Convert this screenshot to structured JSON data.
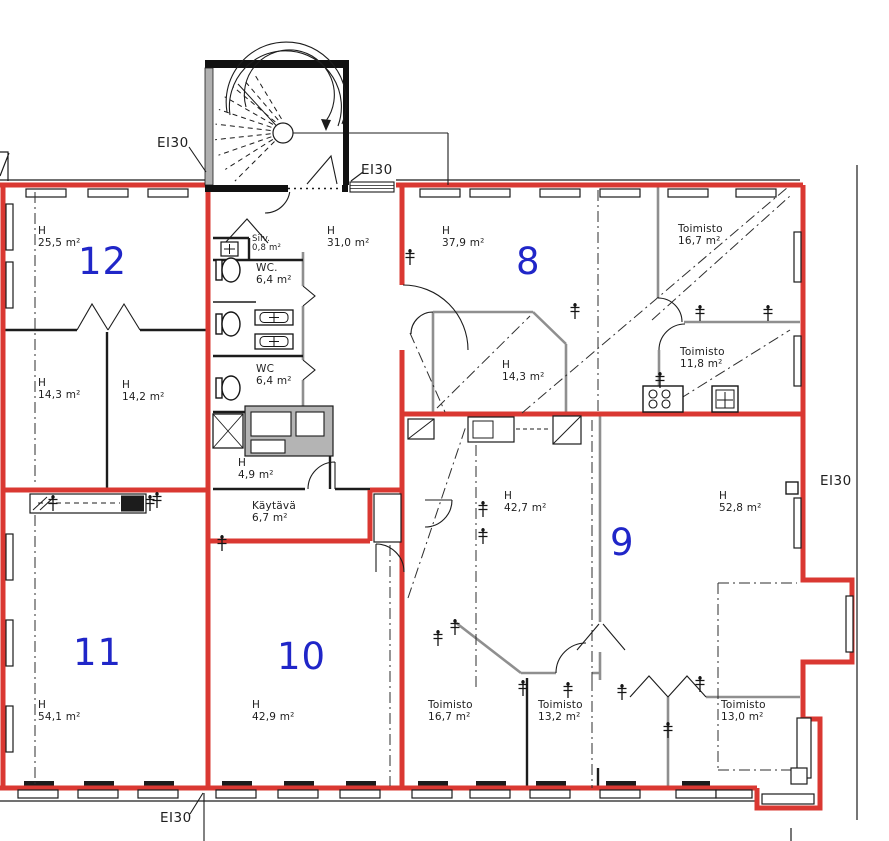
{
  "title": "Floor plan with fire compartment boundaries",
  "colors": {
    "compartment_line_red": "#da3832",
    "room_number_blue": "#2026c8",
    "wall_black": "#1c1c1c",
    "partition_gray": "#8f8f8f"
  },
  "fire_rating_labels": [
    {
      "label": "EI30"
    },
    {
      "label": "EI30"
    },
    {
      "label": "EI30"
    },
    {
      "label": "EI30"
    }
  ],
  "room_numbers": [
    {
      "label": "12"
    },
    {
      "label": "8"
    },
    {
      "label": "9"
    },
    {
      "label": "10"
    },
    {
      "label": "11"
    }
  ],
  "area_labels": [
    {
      "name": "H",
      "area": "25,5 m²"
    },
    {
      "name": "H",
      "area": "14,3 m²"
    },
    {
      "name": "H",
      "area": "14,2 m²"
    },
    {
      "name": "H",
      "area": "54,1 m²"
    },
    {
      "name": "Siiv.",
      "area": "0,8 m²"
    },
    {
      "name": "WC.",
      "area": "6,4 m²"
    },
    {
      "name": "WC",
      "area": "6,4 m²"
    },
    {
      "name": "H",
      "area": "4,9 m²"
    },
    {
      "name": "Käytävä",
      "area": "6,7 m²"
    },
    {
      "name": "H",
      "area": "31,0 m²"
    },
    {
      "name": "H",
      "area": "42,9 m²"
    },
    {
      "name": "H",
      "area": "37,9 m²"
    },
    {
      "name": "Toimisto",
      "area": "16,7 m²"
    },
    {
      "name": "H",
      "area": "14,3 m²"
    },
    {
      "name": "Toimisto",
      "area": "11,8 m²"
    },
    {
      "name": "H",
      "area": "42,7 m²"
    },
    {
      "name": "H",
      "area": "52,8 m²"
    },
    {
      "name": "Toimisto",
      "area": "16,7 m²"
    },
    {
      "name": "Toimisto",
      "area": "13,2 m²"
    },
    {
      "name": "Toimisto",
      "area": "13,0 m²"
    }
  ]
}
